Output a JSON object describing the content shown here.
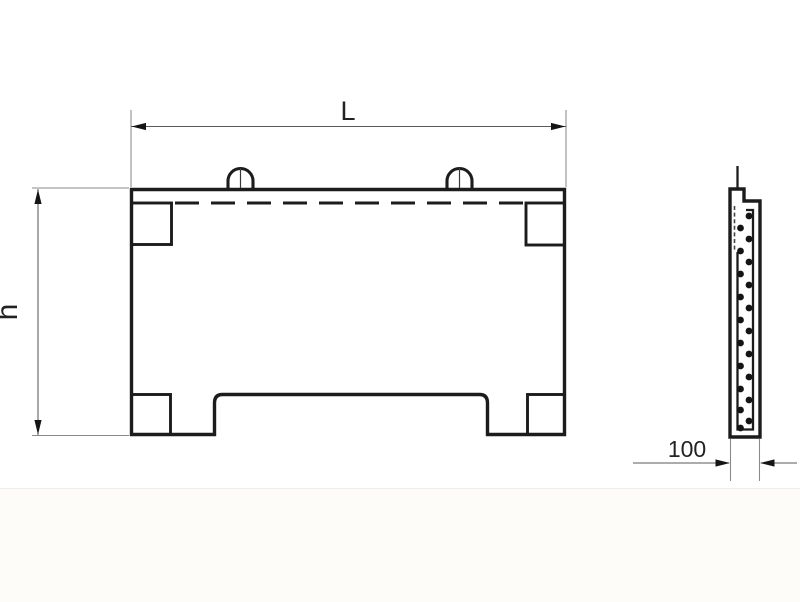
{
  "drawing": {
    "kind": "technical-drawing",
    "subject": "reinforced concrete fence panel — front view and side section",
    "colors": {
      "line": "#1c1c1c",
      "dim_line": "#5a5a5a",
      "ext_line": "#8a8a8a",
      "text": "#222222",
      "bg": "#ffffff",
      "bg_lower": "#fdfcf8"
    },
    "labels": {
      "length": "L",
      "height": "h",
      "thickness": "100"
    },
    "section_view": {
      "rebar_dots": {
        "left_x": 740.5,
        "right_x": 749,
        "radius": 3.4,
        "left_y": [
          228,
          251,
          274,
          297,
          320,
          343,
          366,
          389,
          410,
          428
        ],
        "right_y": [
          216,
          239,
          262,
          285,
          308,
          331,
          354,
          377,
          400,
          421
        ]
      }
    }
  }
}
